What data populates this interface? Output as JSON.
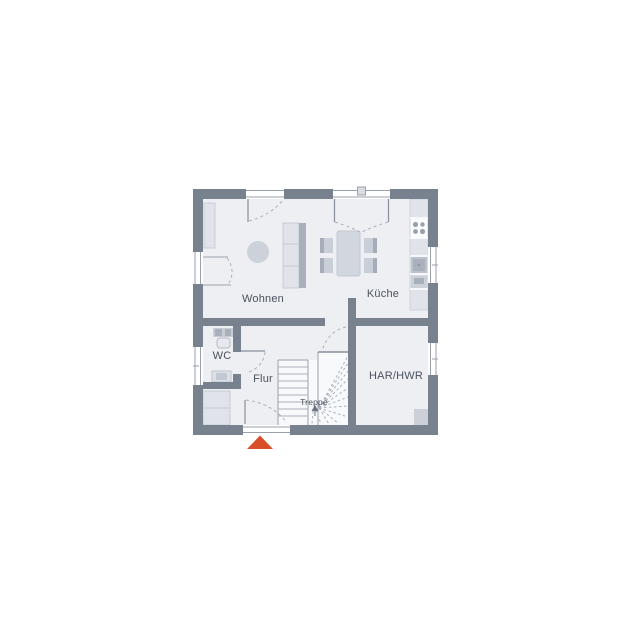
{
  "floorplan": {
    "title": "floor-plan",
    "labels": {
      "wohnen": "Wohnen",
      "kueche": "Küche",
      "wc": "WC",
      "flur": "Flur",
      "treppe": "Treppe",
      "har_hwr": "HAR/HWR"
    },
    "rooms": [
      {
        "id": "wohnen",
        "label": "Wohnen"
      },
      {
        "id": "kueche",
        "label": "Küche"
      },
      {
        "id": "wc",
        "label": "WC"
      },
      {
        "id": "flur",
        "label": "Flur"
      },
      {
        "id": "treppe",
        "label": "Treppe"
      },
      {
        "id": "har_hwr",
        "label": "HAR/HWR"
      }
    ],
    "colors": {
      "wall": "#78828e",
      "floor": "#edeff3",
      "stair_floor": "#f8f9fb",
      "furniture_light": "#e0e3e9",
      "furniture_mid": "#ccd1da",
      "furniture_dark": "#a9b0bc",
      "outline": "#9aa0ac",
      "step_line": "#aab0bb",
      "text": "#4b525c",
      "entrance_marker": "#d8502a"
    }
  }
}
